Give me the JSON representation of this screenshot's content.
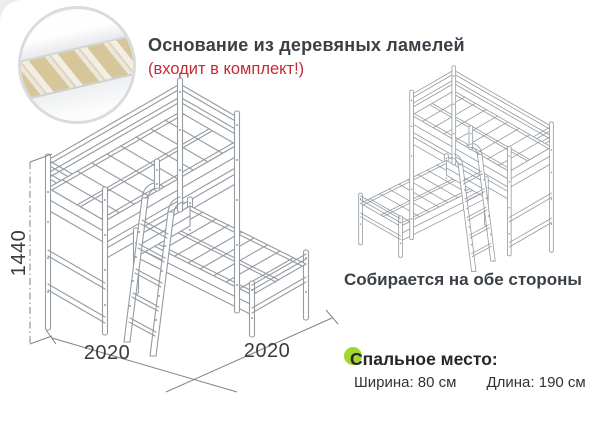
{
  "header": {
    "title": "Основание из деревяных ламелей",
    "subtitle": "(входит в комплект!)"
  },
  "inset": {
    "label": "wooden-slats-base-photo"
  },
  "diagram": {
    "height_label": "1440",
    "width_left_label": "2020",
    "width_right_label": "2020"
  },
  "right_caption": "Собирается на обе стороны",
  "sleeping": {
    "heading": "Спальное место:",
    "width_spec": "Ширина: 80 см",
    "length_spec": "Длина: 190 см"
  },
  "colors": {
    "accent_red": "#c22b38",
    "accent_green": "#a3d62f",
    "line_gray": "#949ba1"
  }
}
